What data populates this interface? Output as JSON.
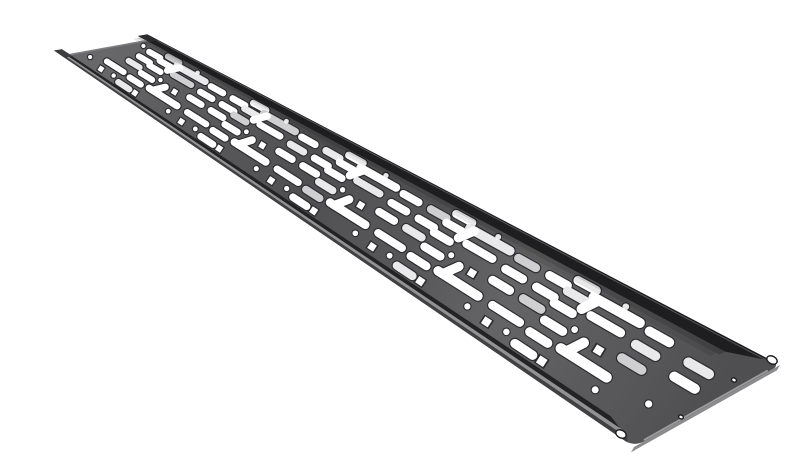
{
  "description": "Black perforated steel cable management tray photographed diagonally on a white background",
  "canvas": {
    "width": 800,
    "height": 471
  },
  "colors": {
    "background": "#ffffff",
    "surface": "#535355",
    "far_flange": "#1e1e20",
    "far_flange_lip": "#55555a",
    "near_outer_face": "#414143",
    "near_rim_light": "#929294",
    "near_inner_dark": "#232325",
    "end_face": "#8b8c8e",
    "end_edge_light": "#9c9c9e",
    "far_end_edge": "#7e7e80",
    "slot_fill": "#ffffff",
    "slot_fill_alt": "#e9e9eb",
    "slot_fill_ghost": "#cfcfd2",
    "slot_rim": "#2b2b2f",
    "tip_dark": "#2b2b2d",
    "tip_mid": "#3d3d3f",
    "hole_fill": "#ffffff",
    "hole_rim": "#1d1d1f",
    "shadow_band_strong": "rgba(0,0,0,0.20)",
    "shadow_band_soft": "rgba(0,0,0,0.09)"
  },
  "tray": {
    "corners": {
      "far_near": [
        22,
        40
      ],
      "far_far": [
        116,
        23
      ],
      "near_far": [
        740,
        349
      ],
      "near_near": [
        594,
        431
      ]
    },
    "corner_radii": [
      3,
      3,
      9,
      12
    ],
    "length_units": 560,
    "width_units": 100,
    "perspective": 0.71,
    "far_flange": {
      "v0": 1.0,
      "v1": 0.9,
      "te0": 0.988,
      "te1": 0.935,
      "tip_t": -0.014,
      "lip_v": 0.985
    },
    "near_flange_bands": [
      {
        "v0": 0.0,
        "v1": 0.027,
        "te0": 0.988,
        "te1": 0.982,
        "color_key": "near_outer_face"
      },
      {
        "v0": 0.027,
        "v1": 0.052,
        "te0": 0.98,
        "te1": 0.968,
        "color_key": "near_rim_light"
      },
      {
        "v0": 0.052,
        "v1": 0.085,
        "te0": 0.962,
        "te1": 0.938,
        "color_key": "near_inner_dark"
      }
    ],
    "near_tip_t": -0.014,
    "shadow_bands": [
      {
        "v0": 0.86,
        "v1": 0.9,
        "te0": 0.935,
        "te1": 0.935,
        "color_key": "shadow_band_strong"
      },
      {
        "v0": 0.82,
        "v1": 0.86,
        "te0": 0.93,
        "te1": 0.93,
        "color_key": "shadow_band_soft"
      }
    ],
    "end_face_depth": 6,
    "sheen_stops": [
      {
        "o": 0.0,
        "c": "rgba(255,255,255,0.12)"
      },
      {
        "o": 0.15,
        "c": "rgba(255,255,255,0.04)"
      },
      {
        "o": 0.35,
        "c": "rgba(0,0,0,0.05)"
      },
      {
        "o": 0.52,
        "c": "rgba(255,255,255,0.02)"
      },
      {
        "o": 0.68,
        "c": "rgba(255,255,255,0.10)"
      },
      {
        "o": 0.84,
        "c": "rgba(255,255,255,0.04)"
      },
      {
        "o": 1.0,
        "c": "rgba(0,0,0,0.05)"
      }
    ]
  },
  "pattern": {
    "module_length": 100,
    "module_count": 5,
    "start_x": 18,
    "pill": {
      "len": 14,
      "h": 6.2
    },
    "l_slot": {
      "len": 34,
      "h": 6.8,
      "stub": 13
    },
    "medium": {
      "len": 22,
      "h": 6.0
    },
    "square_size": 5.5,
    "dot_r": 2.2,
    "pills": [
      [
        2,
        76
      ],
      [
        6,
        62
      ],
      [
        10,
        48
      ],
      [
        16,
        84
      ],
      [
        20,
        72
      ],
      [
        24,
        58
      ],
      [
        33,
        42
      ],
      [
        36,
        28
      ],
      [
        39,
        14
      ],
      [
        77,
        76
      ],
      [
        81,
        62
      ],
      [
        85,
        48
      ]
    ],
    "l_slots": [
      {
        "x": 34,
        "y": 78,
        "stub_x": 38,
        "dir": -1
      },
      {
        "x": 58,
        "y": 30,
        "stub_x": 62,
        "dir": 1
      }
    ],
    "mediums": [
      [
        46,
        64
      ],
      [
        4,
        30
      ]
    ],
    "squares": [
      [
        14,
        16
      ],
      [
        60,
        14
      ],
      [
        72,
        44
      ]
    ],
    "dots": [
      [
        28,
        18
      ],
      [
        52,
        84
      ],
      [
        50,
        48
      ],
      [
        96,
        18
      ]
    ],
    "extra_pills": [
      [
        528,
        70
      ],
      [
        532,
        56
      ]
    ],
    "extra_dots": [
      [
        540,
        30
      ],
      [
        10,
        22
      ],
      [
        8,
        80
      ]
    ]
  },
  "end_holes": [
    {
      "x": 732,
      "y": 344,
      "rx": 5.5,
      "ry": 3.8,
      "rot": 28
    },
    {
      "x": 581,
      "y": 418,
      "rx": 5.5,
      "ry": 3.8,
      "rot": 28
    },
    {
      "x": 694,
      "y": 364,
      "rx": 2.6,
      "ry": 2.0,
      "rot": 28
    },
    {
      "x": 641,
      "y": 401,
      "rx": 2.4,
      "ry": 1.9,
      "rot": 28
    }
  ]
}
